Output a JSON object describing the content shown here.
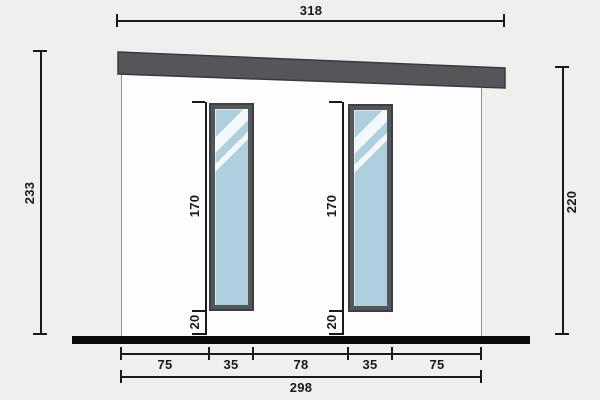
{
  "diagram": {
    "type": "building-side-elevation",
    "dims": {
      "roof_width": "318",
      "wall_height_left": "233",
      "wall_height_right": "220",
      "window1": {
        "height": "170",
        "sill": "20"
      },
      "window2": {
        "height": "170",
        "sill": "20"
      },
      "bottom_segments": [
        "75",
        "35",
        "78",
        "35",
        "75"
      ],
      "base_width": "298"
    },
    "colors": {
      "background": "#efefee",
      "wall": "#fdfdfd",
      "roof": "#55565a",
      "window_frame": "#55565a",
      "glass": "#aecfdd",
      "ground": "#0b0b0b",
      "dim": "#1a1a1a"
    }
  }
}
